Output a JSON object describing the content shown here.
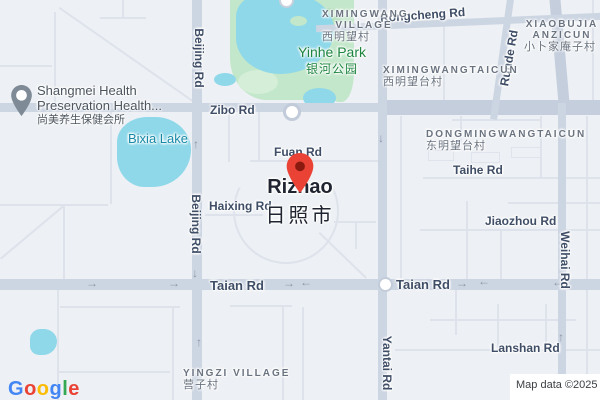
{
  "map": {
    "attribution": "Map data ©2025"
  },
  "logo": {
    "letters": [
      {
        "ch": "G"
      },
      {
        "ch": "o"
      },
      {
        "ch": "o"
      },
      {
        "ch": "g"
      },
      {
        "ch": "l"
      },
      {
        "ch": "e"
      }
    ]
  },
  "city": {
    "name": "Rizhao",
    "name_cn": "日照市"
  },
  "poi_shangmei": {
    "line1": "Shangmei Health",
    "line2": "Preservation Health...",
    "cn": "尚美养生保健会所"
  },
  "park_yinhe": {
    "name": "Yinhe Park",
    "cn": "银河公园"
  },
  "lake_bixia": {
    "name": "Bixia Lake"
  },
  "villages": [
    {
      "line1": "XIMINGWANG",
      "line2": "VILLAGE",
      "cn": "西明望村"
    },
    {
      "line1": "XIAOBUJIA",
      "line2": "ANZICUN",
      "cn": "小卜家庵子村"
    },
    {
      "line1": "XIMINGWANGTAICUN",
      "cn": "西明望台村"
    },
    {
      "line1": "DONGMINGWANGTAICUN",
      "cn": "东明望台村"
    },
    {
      "line1": "YINGZI VILLAGE",
      "cn": "营子村"
    }
  ],
  "road_labels": {
    "rongcheng": "Rongcheng Rd",
    "zibo": "Zibo Rd",
    "runde": "Runde Rd",
    "fuan": "Fuan Rd",
    "haixing": "Haixing Rd",
    "taihe": "Taihe Rd",
    "jiaozhou": "Jiaozhou Rd",
    "weihai": "Weihai Rd",
    "taian_w": "Taian Rd",
    "taian_e": "Taian Rd",
    "beijing_n": "Beijing Rd",
    "beijing_s": "Beijing Rd",
    "yantai": "Yantai Rd",
    "lanshan": "Lanshan Rd"
  },
  "icons": {
    "arrow_right": "→",
    "arrow_left": "←",
    "arrow_up": "↑",
    "arrow_down": "↓"
  },
  "colors": {
    "pin_red": "#EA4335",
    "pin_red_dot": "#8a1a10",
    "poi_pin_gray": "#7e8a96",
    "water": "#8ed8ea",
    "park": "#c3e7ca",
    "road_major": "#ccd5e2",
    "road_label": "#3f4e66",
    "water_label": "#1789a6",
    "park_label": "#1d8540",
    "google_blue": "#4285F4",
    "google_red": "#EA4335",
    "google_yellow": "#FBBC05",
    "google_green": "#34A853"
  }
}
